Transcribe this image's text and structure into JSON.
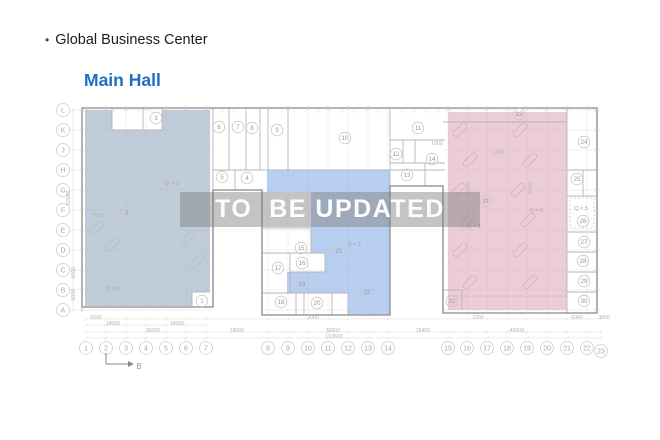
{
  "header": {
    "bullet": "•",
    "title": "Global Business Center"
  },
  "page": {
    "hall_link": "Main Hall"
  },
  "watermark": {
    "text": "TO  BE UPDATED"
  },
  "colors": {
    "link_blue": "#1e6ec5",
    "zone_left": "#8ea3bd",
    "zone_middle": "#7fa7e6",
    "zone_right": "#d795ab",
    "outline": "#9c9c9c",
    "wall": "#b6b6b6",
    "grid": "#e3e3e3",
    "axis_stroke": "#cdcdcd",
    "axis_text": "#a8a8a8",
    "room_stroke": "#c6c6c6",
    "room_text": "#9a9a9a",
    "dim_text": "#b4b4b4",
    "dim_line": "#dedede",
    "hatch_pink": "#cf9db2",
    "hatch_blue": "#a9b6c8",
    "marker": "#8a8a8a"
  },
  "plan": {
    "outline": [
      [
        82,
        108
      ],
      [
        597,
        108
      ],
      [
        597,
        313
      ],
      [
        443,
        313
      ],
      [
        443,
        186
      ],
      [
        390,
        186
      ],
      [
        390,
        315
      ],
      [
        262,
        315
      ],
      [
        262,
        190
      ],
      [
        213,
        190
      ],
      [
        213,
        307
      ],
      [
        82,
        307
      ]
    ],
    "regions": [
      {
        "name": "left-zone",
        "fill": "#8ea3bd",
        "opacity": 0.55,
        "points": [
          [
            85,
            110
          ],
          [
            112,
            110
          ],
          [
            112,
            130
          ],
          [
            162,
            130
          ],
          [
            162,
            110
          ],
          [
            210,
            110
          ],
          [
            210,
            292
          ],
          [
            192,
            292
          ],
          [
            192,
            306
          ],
          [
            85,
            306
          ]
        ]
      },
      {
        "name": "middle-zone",
        "fill": "#7fa7e6",
        "opacity": 0.55,
        "points": [
          [
            267,
            170
          ],
          [
            390,
            170
          ],
          [
            390,
            315
          ],
          [
            348,
            315
          ],
          [
            348,
            293
          ],
          [
            287,
            293
          ],
          [
            287,
            272
          ],
          [
            325,
            272
          ],
          [
            325,
            253
          ],
          [
            311,
            253
          ],
          [
            311,
            192
          ],
          [
            267,
            192
          ]
        ]
      },
      {
        "name": "right-zone",
        "fill": "#d795ab",
        "opacity": 0.48,
        "points": [
          [
            448,
            112
          ],
          [
            567,
            112
          ],
          [
            567,
            310
          ],
          [
            448,
            310
          ]
        ]
      }
    ],
    "walls": [
      [
        213,
        108,
        213,
        190
      ],
      [
        229,
        108,
        229,
        170
      ],
      [
        246,
        108,
        246,
        170
      ],
      [
        260,
        108,
        260,
        170
      ],
      [
        268,
        108,
        268,
        170
      ],
      [
        288,
        108,
        288,
        170
      ],
      [
        213,
        170,
        445,
        170
      ],
      [
        235,
        170,
        235,
        190
      ],
      [
        390,
        108,
        390,
        186
      ],
      [
        390,
        140,
        445,
        140
      ],
      [
        415,
        140,
        415,
        163
      ],
      [
        390,
        163,
        445,
        163
      ],
      [
        425,
        163,
        425,
        186
      ],
      [
        403,
        140,
        403,
        163
      ],
      [
        112,
        108,
        112,
        130
      ],
      [
        112,
        130,
        162,
        130
      ],
      [
        162,
        108,
        162,
        130
      ],
      [
        143,
        108,
        143,
        130
      ],
      [
        192,
        292,
        192,
        307
      ],
      [
        192,
        292,
        210,
        292
      ],
      [
        262,
        228,
        311,
        228
      ],
      [
        311,
        228,
        311,
        253
      ],
      [
        262,
        253,
        325,
        253
      ],
      [
        290,
        253,
        290,
        293
      ],
      [
        325,
        253,
        325,
        272
      ],
      [
        290,
        272,
        325,
        272
      ],
      [
        262,
        293,
        348,
        293
      ],
      [
        296,
        293,
        296,
        315
      ],
      [
        304,
        293,
        304,
        315
      ],
      [
        332,
        293,
        332,
        315
      ],
      [
        348,
        293,
        348,
        315
      ],
      [
        567,
        108,
        567,
        313
      ],
      [
        567,
        170,
        597,
        170
      ],
      [
        567,
        196,
        597,
        196
      ],
      [
        567,
        232,
        597,
        232
      ],
      [
        567,
        252,
        597,
        252
      ],
      [
        567,
        272,
        597,
        272
      ],
      [
        567,
        292,
        597,
        292
      ],
      [
        583,
        170,
        583,
        196
      ],
      [
        443,
        122,
        567,
        122
      ],
      [
        443,
        290,
        462,
        290
      ],
      [
        462,
        290,
        462,
        310
      ]
    ],
    "dashed_rects": [
      {
        "x": 570,
        "y": 198,
        "w": 24,
        "h": 30
      }
    ],
    "dashed_lines": [
      [
        448,
        296,
        567,
        296
      ]
    ],
    "rows": [
      {
        "label": "L",
        "y": 110
      },
      {
        "label": "K",
        "y": 130
      },
      {
        "label": "J",
        "y": 150
      },
      {
        "label": "H",
        "y": 170
      },
      {
        "label": "G",
        "y": 190
      },
      {
        "label": "F",
        "y": 210
      },
      {
        "label": "E",
        "y": 230
      },
      {
        "label": "D",
        "y": 250
      },
      {
        "label": "C",
        "y": 270
      },
      {
        "label": "B",
        "y": 290
      },
      {
        "label": "A",
        "y": 310
      }
    ],
    "rows_x": 63,
    "cols": [
      {
        "label": "1",
        "x": 86
      },
      {
        "label": "2",
        "x": 106
      },
      {
        "label": "3",
        "x": 126
      },
      {
        "label": "4",
        "x": 146
      },
      {
        "label": "5",
        "x": 166
      },
      {
        "label": "6",
        "x": 186
      },
      {
        "label": "7",
        "x": 206
      },
      {
        "label": "8",
        "x": 268
      },
      {
        "label": "9",
        "x": 288
      },
      {
        "label": "10",
        "x": 308
      },
      {
        "label": "11",
        "x": 328
      },
      {
        "label": "12",
        "x": 348
      },
      {
        "label": "13",
        "x": 368
      },
      {
        "label": "14",
        "x": 388
      },
      {
        "label": "15",
        "x": 448
      },
      {
        "label": "16",
        "x": 467
      },
      {
        "label": "17",
        "x": 487
      },
      {
        "label": "18",
        "x": 507
      },
      {
        "label": "19",
        "x": 527
      },
      {
        "label": "20",
        "x": 547
      },
      {
        "label": "21",
        "x": 567
      },
      {
        "label": "22",
        "x": 587
      },
      {
        "label": "23",
        "x": 601,
        "y": 351
      }
    ],
    "cols_y": 348,
    "rooms": [
      {
        "n": "1",
        "x": 202,
        "y": 301
      },
      {
        "n": "2",
        "x": 127,
        "y": 213
      },
      {
        "n": "3",
        "x": 156,
        "y": 118
      },
      {
        "n": "4",
        "x": 247,
        "y": 178
      },
      {
        "n": "5",
        "x": 222,
        "y": 177
      },
      {
        "n": "6",
        "x": 219,
        "y": 127
      },
      {
        "n": "7",
        "x": 238,
        "y": 127
      },
      {
        "n": "8",
        "x": 252,
        "y": 128
      },
      {
        "n": "9",
        "x": 277,
        "y": 130
      },
      {
        "n": "10",
        "x": 345,
        "y": 138
      },
      {
        "n": "11",
        "x": 418,
        "y": 128
      },
      {
        "n": "12",
        "x": 396,
        "y": 154
      },
      {
        "n": "13",
        "x": 407,
        "y": 175
      },
      {
        "n": "14",
        "x": 432,
        "y": 159
      },
      {
        "n": "15",
        "x": 301,
        "y": 248
      },
      {
        "n": "16",
        "x": 302,
        "y": 263
      },
      {
        "n": "17",
        "x": 278,
        "y": 268
      },
      {
        "n": "18",
        "x": 281,
        "y": 302
      },
      {
        "n": "19",
        "x": 302,
        "y": 284
      },
      {
        "n": "20",
        "x": 317,
        "y": 303
      },
      {
        "n": "21",
        "x": 339,
        "y": 251
      },
      {
        "n": "22",
        "x": 367,
        "y": 292
      },
      {
        "n": "23",
        "x": 519,
        "y": 114
      },
      {
        "n": "24",
        "x": 584,
        "y": 142
      },
      {
        "n": "25",
        "x": 577,
        "y": 179
      },
      {
        "n": "26",
        "x": 583,
        "y": 221
      },
      {
        "n": "27",
        "x": 584,
        "y": 242
      },
      {
        "n": "28",
        "x": 583,
        "y": 261
      },
      {
        "n": "29",
        "x": 584,
        "y": 281
      },
      {
        "n": "30",
        "x": 584,
        "y": 301
      },
      {
        "n": "31",
        "x": 486,
        "y": 201
      },
      {
        "n": "32",
        "x": 452,
        "y": 301
      }
    ],
    "dims": [
      {
        "t": "6000",
        "x": 96,
        "y": 317
      },
      {
        "t": "2000",
        "x": 313,
        "y": 317
      },
      {
        "t": "1000",
        "x": 478,
        "y": 317
      },
      {
        "t": "6000",
        "x": 577,
        "y": 317
      },
      {
        "t": "3000",
        "x": 604,
        "y": 317
      },
      {
        "t": "18000",
        "x": 113,
        "y": 323
      },
      {
        "t": "18000",
        "x": 177,
        "y": 323
      },
      {
        "t": "36000",
        "x": 153,
        "y": 330
      },
      {
        "t": "18000",
        "x": 237,
        "y": 330
      },
      {
        "t": "36000",
        "x": 333,
        "y": 330
      },
      {
        "t": "18400",
        "x": 423,
        "y": 330
      },
      {
        "t": "45000",
        "x": 517,
        "y": 330
      },
      {
        "t": "153600",
        "x": 334,
        "y": 336
      },
      {
        "t": "60000",
        "x": 70,
        "y": 196,
        "rot": true
      },
      {
        "t": "6000",
        "x": 75,
        "y": 271,
        "rot": true
      },
      {
        "t": "6000",
        "x": 75,
        "y": 293,
        "rot": true
      },
      {
        "t": "1000",
        "x": 437,
        "y": 143
      },
      {
        "t": "1300",
        "x": 498,
        "y": 152
      },
      {
        "t": "2000",
        "x": 97,
        "y": 215
      },
      {
        "t": "6000",
        "x": 470,
        "y": 186,
        "rot": true
      },
      {
        "t": "6000",
        "x": 532,
        "y": 186,
        "rot": true
      }
    ],
    "zone_labels": [
      {
        "t": "Q = 3",
        "x": 172,
        "y": 183
      },
      {
        "t": "Q = 3",
        "x": 113,
        "y": 288
      },
      {
        "t": "Q = 3",
        "x": 354,
        "y": 244
      },
      {
        "t": "Q = 3",
        "x": 536,
        "y": 210
      },
      {
        "t": "Q = 3",
        "x": 474,
        "y": 226
      },
      {
        "t": "Q = 5",
        "x": 581,
        "y": 208
      }
    ],
    "dim_lines": [
      {
        "y": 319,
        "x1": 86,
        "x2": 601
      },
      {
        "y": 325,
        "x1": 86,
        "x2": 206
      },
      {
        "y": 332,
        "x1": 86,
        "x2": 601
      },
      {
        "y": 338,
        "x1": 86,
        "x2": 601
      }
    ],
    "left_dim_line": {
      "x": 73,
      "y1": 110,
      "y2": 310
    },
    "hatches_pink": [
      [
        460,
        130
      ],
      [
        470,
        160
      ],
      [
        458,
        190
      ],
      [
        468,
        220
      ],
      [
        460,
        250
      ],
      [
        470,
        282
      ],
      [
        520,
        130
      ],
      [
        530,
        160
      ],
      [
        518,
        190
      ],
      [
        528,
        220
      ],
      [
        520,
        250
      ],
      [
        530,
        282
      ]
    ],
    "hatches_left": [
      [
        97,
        228
      ],
      [
        113,
        244
      ],
      [
        188,
        238
      ],
      [
        197,
        261
      ]
    ],
    "grid_rules": {
      "col_ranges": [
        {
          "min_x": 80,
          "max_x": 210,
          "y1": 110,
          "y2": 306
        },
        {
          "min_x": 260,
          "max_x": 390,
          "y1": 110,
          "y2": 314
        },
        {
          "min_x": 440,
          "max_x": 600,
          "y1": 110,
          "y2": 312
        }
      ],
      "row_ranges": [
        {
          "x1": 84,
          "x2": 212,
          "min_y": 0
        },
        {
          "x1": 263,
          "x2": 389,
          "min_y": 170
        },
        {
          "x1": 444,
          "x2": 596,
          "min_y": 0
        }
      ]
    },
    "section_marker": {
      "label": "B",
      "v": [
        106,
        353,
        106,
        364
      ],
      "h": [
        106,
        364,
        128,
        364
      ],
      "tip": [
        [
          128,
          361
        ],
        [
          128,
          367
        ],
        [
          134,
          364
        ]
      ],
      "label_pos": [
        139,
        369
      ]
    }
  }
}
